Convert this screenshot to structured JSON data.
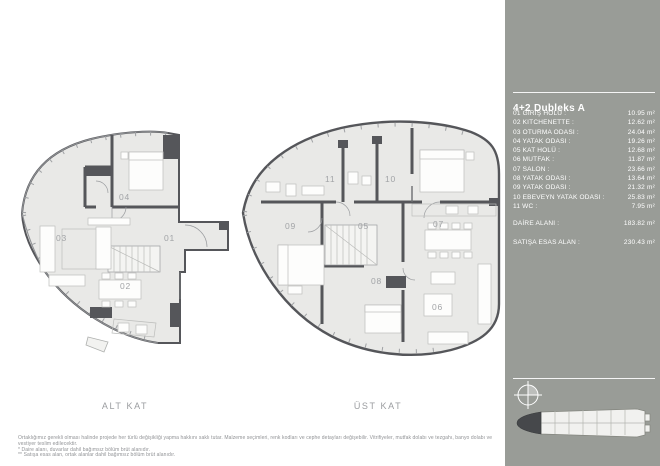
{
  "panel": {
    "title": "4+2 Dubleks A",
    "rooms": [
      {
        "label": "01 GİRİŞ HOLÜ :",
        "value": "10.95 m²"
      },
      {
        "label": "02 KITCHENETTE :",
        "value": "12.62 m²"
      },
      {
        "label": "03 OTURMA ODASI :",
        "value": "24.04 m²"
      },
      {
        "label": "04 YATAK ODASI :",
        "value": "19.26 m²"
      },
      {
        "label": "05 KAT HOLÜ :",
        "value": "12.68 m²"
      },
      {
        "label": "06 MUTFAK :",
        "value": "11.87 m²"
      },
      {
        "label": "07 SALON :",
        "value": "23.66 m²"
      },
      {
        "label": "08 YATAK ODASI :",
        "value": "13.64 m²"
      },
      {
        "label": "09 YATAK ODASI :",
        "value": "21.32 m²"
      },
      {
        "label": "10 EBEVEYN YATAK ODASI :",
        "value": "25.83 m²"
      },
      {
        "label": "11 WC :",
        "value": "7.95 m²"
      }
    ],
    "totals": [
      {
        "label": "DAİRE ALANI :",
        "value": "183.82 m²"
      },
      {
        "label": "SATIŞA ESAS ALAN :",
        "value": "230.43 m²"
      }
    ]
  },
  "plans": {
    "alt": {
      "name": "ALT KAT",
      "labels": [
        "01",
        "02",
        "03",
        "04"
      ]
    },
    "ust": {
      "name": "ÜST KAT",
      "labels": [
        "05",
        "06",
        "07",
        "08",
        "09",
        "10",
        "11"
      ]
    }
  },
  "footer": {
    "lines": [
      "Ortaklığımız gerekli olması halinde projede her türlü değişikliği yapma hakkını saklı tutar. Malzeme seçimleri, renk kodları ve cephe detayları değişebilir. Vitrifiyeler, mutfak dolabı ve tezgahı, banyo dolabı ve vestiyer teslim edilecektir.",
      "* Daire alanı, duvarlar dahil bağımsız bölüm brüt alanıdır.",
      "** Satışa esas alan, ortak alanlar dahil bağımsız bölüm brüt alanıdır."
    ]
  },
  "colors": {
    "panel_bg": "#999c97",
    "panel_text": "#ffffff",
    "wall": "#55565a",
    "room_fill": "#e9e9e7",
    "plan_label": "#a2a4a7",
    "highlight_unit": "#46484b"
  }
}
